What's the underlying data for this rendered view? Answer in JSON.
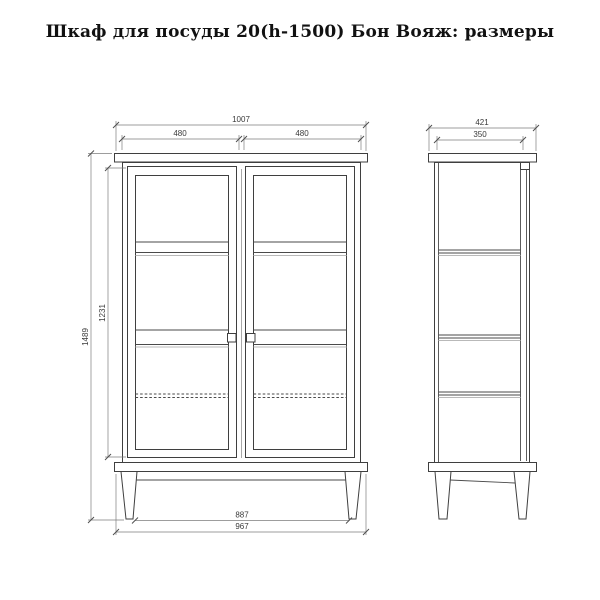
{
  "title": "Шкаф для посуды 20(h-1500) Бон Вояж: размеры",
  "front_view": {
    "width_total": "1007",
    "door_left_width": "480",
    "door_right_width": "480",
    "height_total": "1489",
    "door_height": "1231",
    "base_width_inner": "887",
    "base_width_outer": "967"
  },
  "side_view": {
    "depth_total": "421",
    "depth_body": "350"
  }
}
